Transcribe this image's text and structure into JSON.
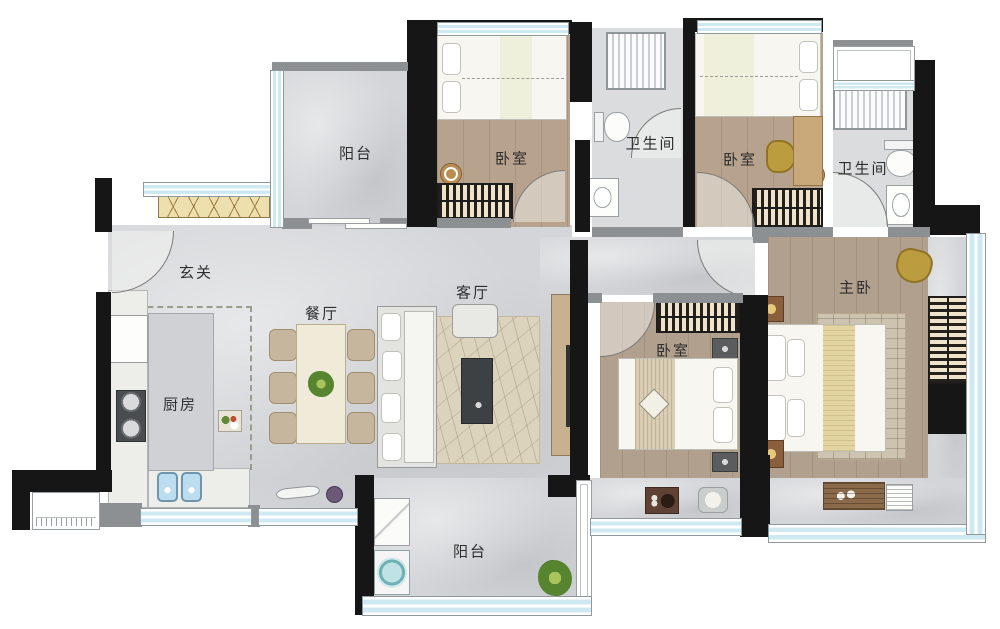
{
  "title": "四房两卫户型平面图",
  "rooms": {
    "balcony_top": "阳台",
    "bedroom_a": "卧室",
    "bathroom_a": "卫生间",
    "bedroom_b": "卧室",
    "bathroom_b": "卫生间",
    "entry": "玄关",
    "dining": "餐厅",
    "living": "客厅",
    "kitchen": "厨房",
    "bedroom_c": "卧室",
    "master": "主卧",
    "balcony_bottom": "阳台"
  },
  "colors": {
    "wall": "#161616",
    "wall_light": "#8d9092",
    "floor_tile": "#d4d5d8",
    "floor_wood": "#b7a28e",
    "window_blue": "#cfe9f2",
    "cabinet_wood": "#eedfae",
    "accent_gold": "#bb9c3f",
    "sink_blue": "#bcdcf0"
  }
}
